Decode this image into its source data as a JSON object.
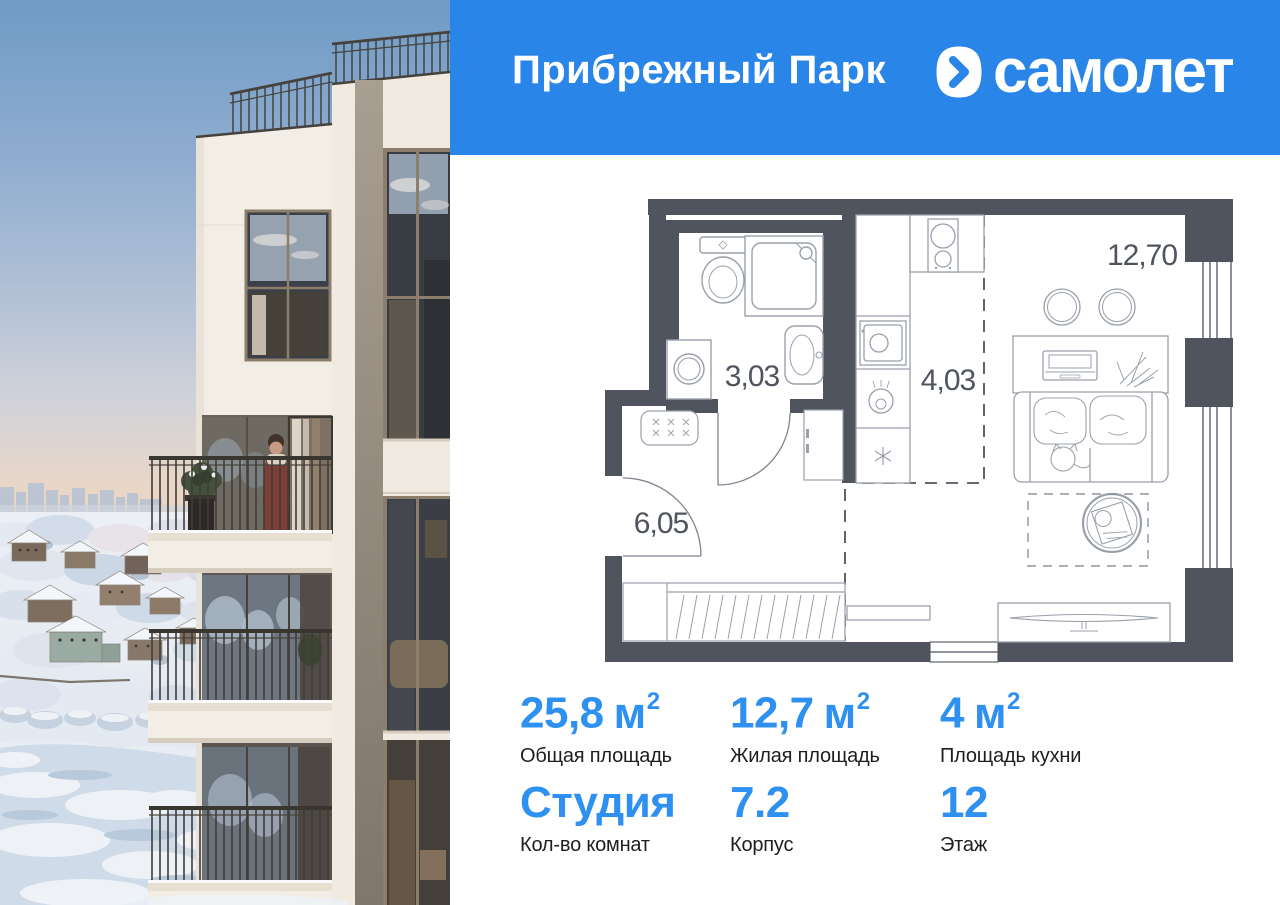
{
  "header": {
    "project_name": "Прибрежный Парк",
    "brand_name": "самолет"
  },
  "colors": {
    "header_blue": "#2a85e8",
    "stats_blue": "#2e90f0",
    "plan_wall": "#4f545e"
  },
  "floorplan": {
    "areas": {
      "bathroom": "3,03",
      "kitchen": "4,03",
      "hallway": "6,05",
      "living_room": "12,70"
    }
  },
  "stats": {
    "cells": [
      {
        "value": "25,8",
        "unit": "м",
        "sup": "2",
        "label": "Общая площадь"
      },
      {
        "value": "12,7",
        "unit": "м",
        "sup": "2",
        "label": "Жилая площадь"
      },
      {
        "value": "4",
        "unit": "м",
        "sup": "2",
        "label": "Площадь кухни"
      },
      {
        "value": "Студия",
        "label": "Кол-во комнат"
      },
      {
        "value": "7.2",
        "label": "Корпус"
      },
      {
        "value": "12",
        "label": "Этаж"
      }
    ]
  }
}
